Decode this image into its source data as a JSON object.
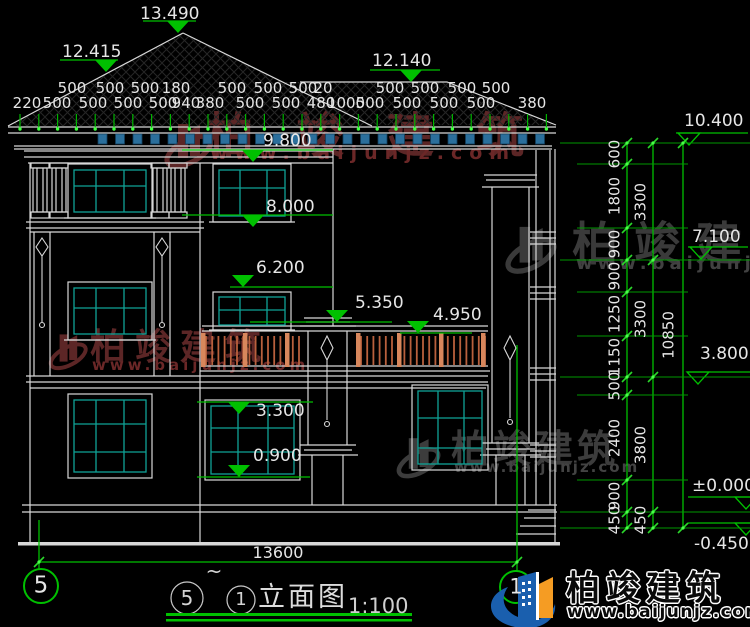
{
  "drawing_title": {
    "left_bubble": "5",
    "tilde": "~",
    "right_bubble": "1",
    "name": "立面图",
    "scale": "1:100"
  },
  "grid_bubbles": {
    "left": "5",
    "right": "1"
  },
  "bottom_dimension": "13600",
  "elevation_markers": {
    "roof_peak": "13.490",
    "roof_left_slope": "12.415",
    "roof_right": "12.140",
    "parapet": "9.800",
    "window3_sill": "8.000",
    "window2_top": "6.200",
    "balcony_rail": "5.350",
    "balcony_floor": "4.950",
    "window1_top": "3.300",
    "window1_sill": "0.900",
    "right_eave": "10.400",
    "right_mid": "7.100",
    "right_low": "3.800",
    "ground_floor": "±0.000",
    "site_level": "-0.450"
  },
  "top_dimensions": {
    "upper_row": [
      "500",
      "500",
      "500",
      "180",
      "500",
      "500",
      "500",
      "20",
      "500",
      "500",
      "500",
      "500"
    ],
    "lower_row": [
      "220",
      "500",
      "500",
      "500",
      "500",
      "940",
      "380",
      "500",
      "500",
      "480",
      "1000",
      "500",
      "500",
      "500",
      "500",
      "380"
    ]
  },
  "right_dimensions": {
    "inner": [
      "600",
      "1800",
      "900",
      "900",
      "1250",
      "1150",
      "500",
      "2400",
      "900",
      "450"
    ],
    "middle": [
      "3300",
      "3300",
      "3800",
      "450"
    ],
    "overall": "10850"
  },
  "watermark": {
    "brand": "柏竣建筑",
    "website": "www.baijunjz.com"
  },
  "footer_logo": {
    "brand": "柏竣建筑",
    "website": "www.baijunjz.com"
  },
  "colors": {
    "dimension_green": "#00c000",
    "tick_green": "#3fff3f",
    "window_teal": "#0fa296",
    "rafter_blue": "#2b6f9c",
    "railing_orange": "#b9603d",
    "railing_post": "#d8875c",
    "watermark_red": "#5c2626",
    "watermark_gray": "#3a3a3a",
    "logo_blue": "#1a5fae",
    "logo_orange": "#f59c23",
    "linework_white": "#d8d8d8"
  }
}
